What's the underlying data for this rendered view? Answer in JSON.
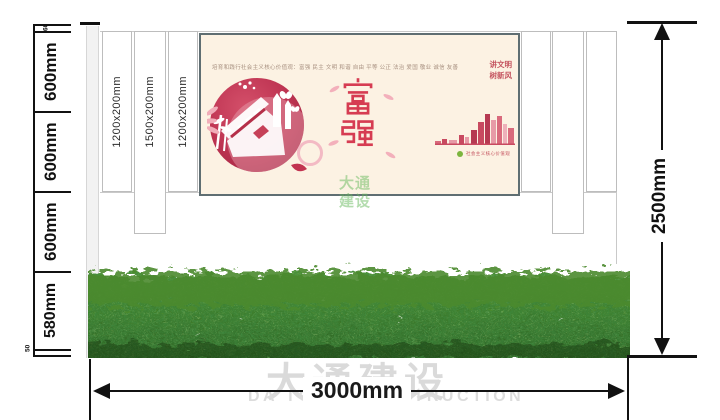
{
  "meta": {
    "drawing_type": "signage wall elevation drawing"
  },
  "dims": {
    "left_segments": [
      "60",
      "600mm",
      "600mm",
      "600mm",
      "580mm",
      "50"
    ],
    "panel_labels": [
      "1200x200mm",
      "1500x200mm",
      "1200x200mm"
    ],
    "height_total": "2500mm",
    "width_total": "3000mm"
  },
  "poster": {
    "header": "培育和践行社会主义核心价值观：富强 民主 文明 和谐 自由 平等 公正 法治 爱国 敬业 诚信 友善",
    "slogan_line1": "讲文明",
    "slogan_line2": "树新风",
    "theme_char1": "富",
    "theme_char2": "强",
    "theme_text": "富强",
    "footnote": "社会主义核心价值观"
  },
  "watermark": {
    "stamp_line1": "大通",
    "stamp_line2": "建设",
    "company_cn": "大通建设",
    "company_en": "DA TONG CONSTRUCTION"
  },
  "colors": {
    "accent_red": "#c84a60",
    "poster_bg": "#fcf2e3",
    "poster_border": "#5f6e72",
    "hedge_green": "#3f7d26",
    "line_black": "#111111",
    "watermark_gray": "#dadada",
    "stamp_green": "#6eba5e"
  }
}
